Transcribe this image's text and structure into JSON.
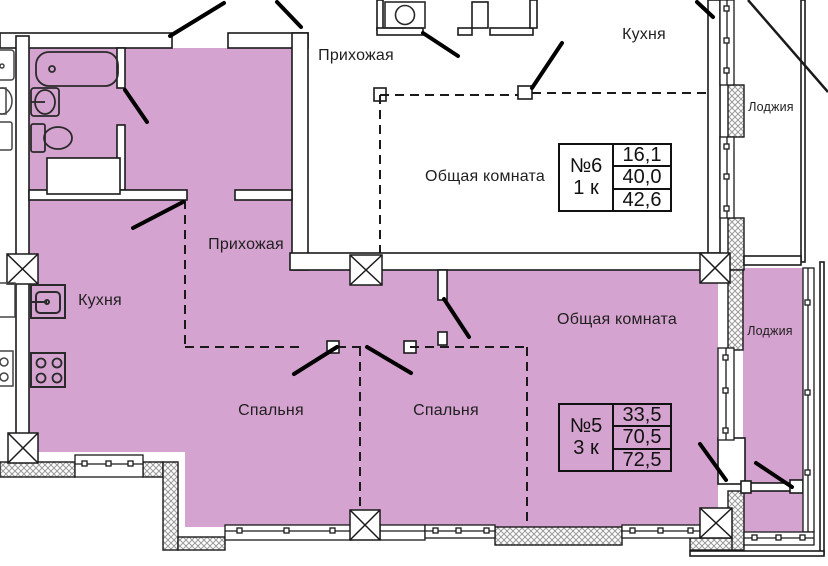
{
  "plan": {
    "highlight_color": "#d5a3cf",
    "apartments": [
      {
        "number": "№6",
        "rooms_count": "1 к",
        "areas": [
          "16,1",
          "40,0",
          "42,6"
        ],
        "labels": {
          "hallway": "Прихожая",
          "kitchen": "Кухня",
          "living": "Общая комната",
          "loggia": "Лоджия"
        }
      },
      {
        "number": "№5",
        "rooms_count": "3 к",
        "areas": [
          "33,5",
          "70,5",
          "72,5"
        ],
        "labels": {
          "hallway": "Прихожая",
          "kitchen": "Кухня",
          "living": "Общая комната",
          "bedroom_1": "Спальня",
          "bedroom_2": "Спальня",
          "loggia": "Лоджия"
        }
      }
    ]
  }
}
